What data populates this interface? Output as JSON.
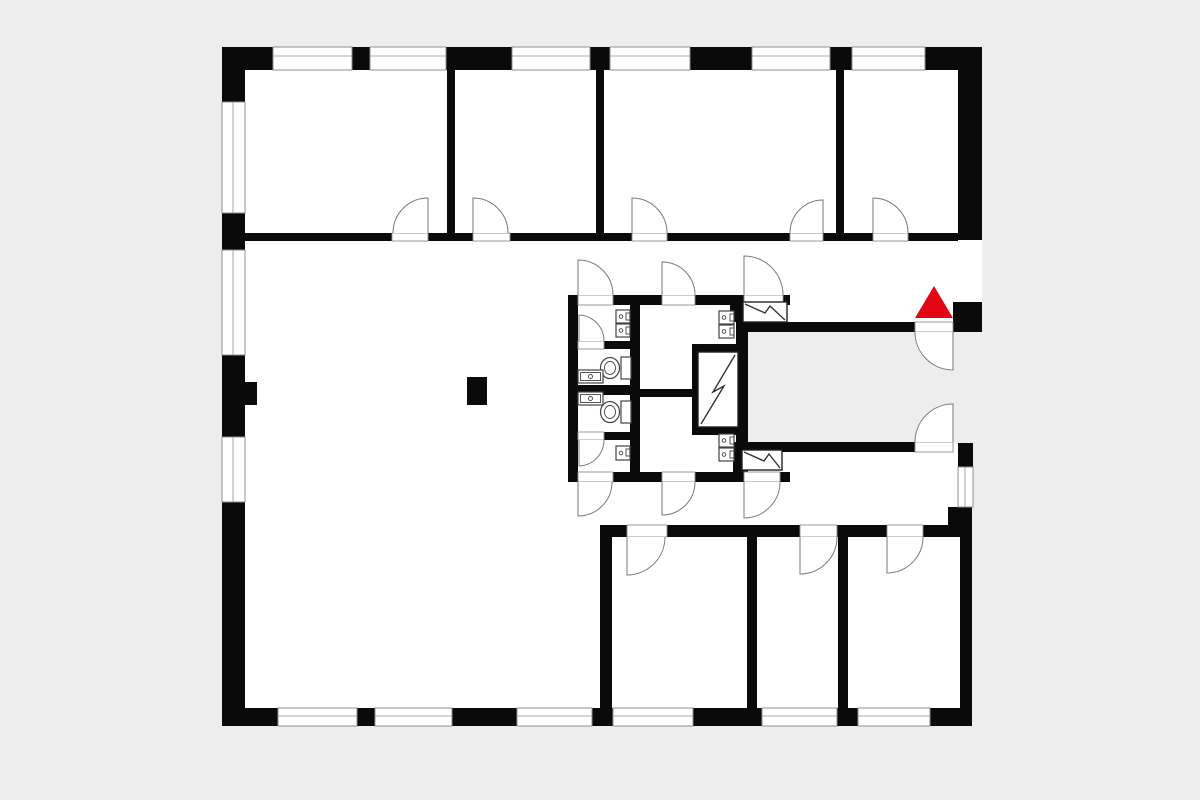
{
  "document": {
    "type": "floor-plan",
    "style": "black-and-white architectural plan",
    "visible_text": ""
  },
  "palette": {
    "background": "#ededed",
    "floor": "#ffffff",
    "wall": "#0a0a0a",
    "door_line": "#7a7a7a",
    "window_line": "#8f8f8f",
    "fixture_line": "#444444",
    "marker": "#e30613"
  },
  "marker": {
    "shape": "triangle-up",
    "color": "#e30613",
    "meaning": "entrance-indicator",
    "location": "east corridor, above courtyard door"
  },
  "plan_summary": {
    "top_rooms": 4,
    "bottom_rooms": 3,
    "large_open_room": 1,
    "wc_cabins": 4,
    "toilets": 2,
    "sinks": 9,
    "shaft_symbols": 3,
    "door_swings": 18,
    "windows": 16,
    "courtyard_notch_open_east": true,
    "freestanding_pillar": 1
  }
}
